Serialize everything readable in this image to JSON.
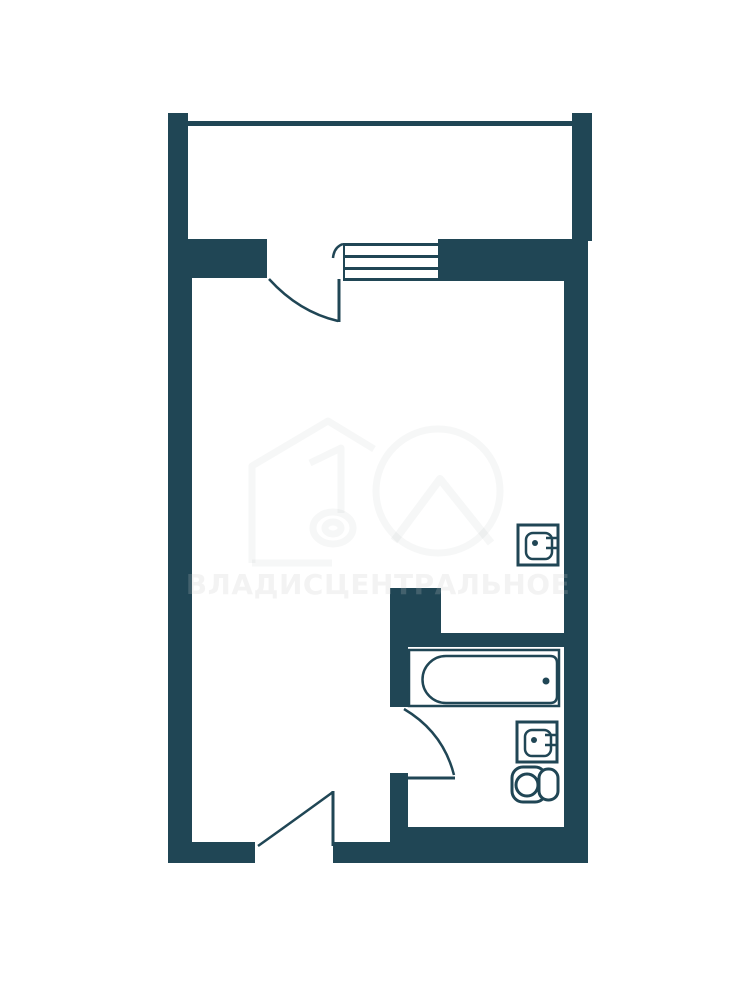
{
  "title": "Studio apartment floor plan",
  "colors": {
    "wall": "#204655",
    "background": "#ffffff",
    "watermark_dark": "rgba(0,0,0,0.055)",
    "watermark_light": "rgba(255,255,255,0.17)",
    "logo_stroke": "rgba(16,42,52,0.04)"
  },
  "watermark": {
    "text": "ВЛАДИСЦЕНТРАЛЬНОЕ",
    "logo": "house-with-number-one-and-circle-logo"
  },
  "plan": {
    "rooms": [
      "balcony",
      "main-room",
      "bathroom"
    ],
    "window": "balcony-window",
    "doors": [
      "balcony-door",
      "entrance-door",
      "bathroom-door"
    ],
    "fixtures": [
      "bathtub",
      "kitchen-sink",
      "bathroom-sink",
      "toilet"
    ]
  }
}
